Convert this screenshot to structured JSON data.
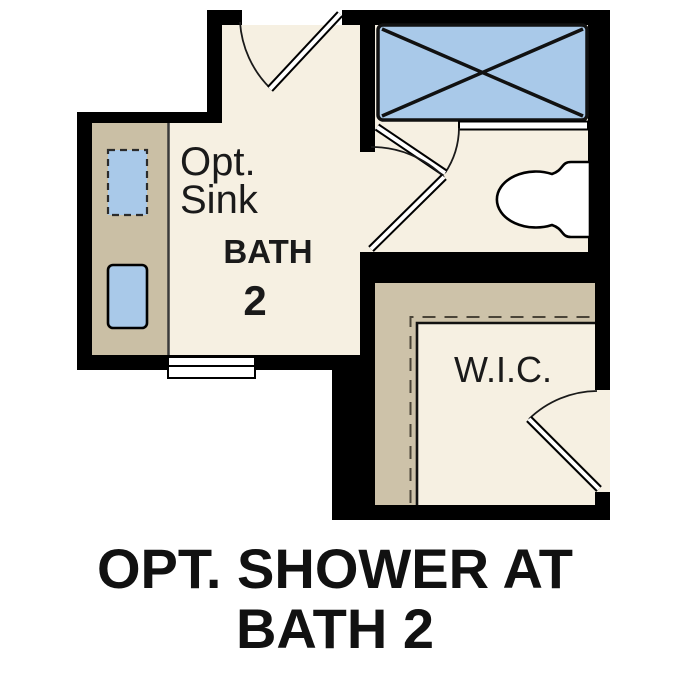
{
  "plan": {
    "title": "floor plan detail: optional shower at bath 2",
    "labels": {
      "opt_line1": "Opt.",
      "opt_line2": "Sink",
      "bath_line1": "BATH",
      "bath_line2": "2",
      "wic": "W.I.C."
    },
    "caption": {
      "line1": "OPT. SHOWER AT",
      "line2": "BATH 2"
    },
    "colors": {
      "floor": "#f6f0e2",
      "counter": "#cabfa5",
      "wic_shelf_tan": "#cdc2a9",
      "fixture_blue": "#a9c9e9",
      "wall": "#000000",
      "text": "#1a1a1a",
      "caption_text": "#111111"
    }
  }
}
